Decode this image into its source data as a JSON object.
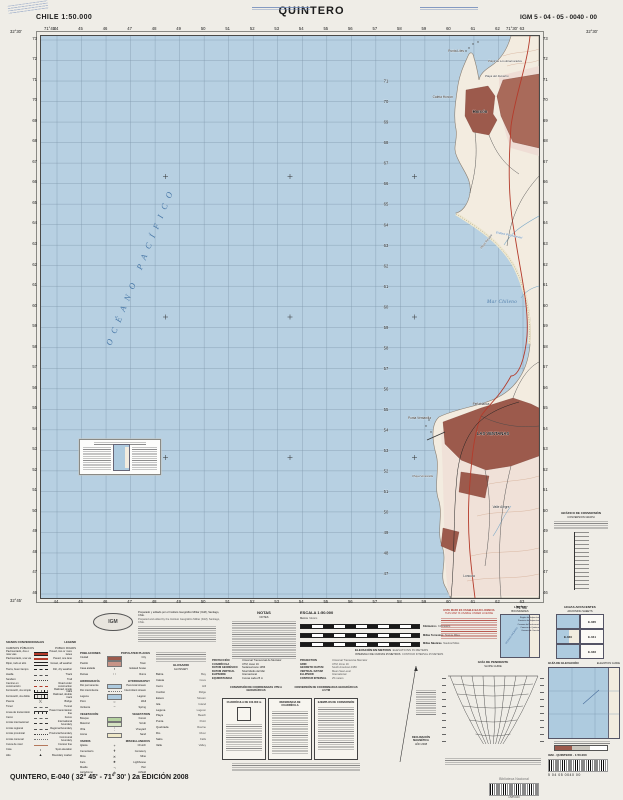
{
  "header": {
    "country_scale": "CHILE  1:50.000",
    "title": "QUINTERO",
    "sheet_code": "IGM 5 - 04 - 05 - 0040 - 00"
  },
  "map": {
    "grid": {
      "eastings": [
        "44",
        "45",
        "46",
        "47",
        "48",
        "49",
        "50",
        "51",
        "52",
        "53",
        "54",
        "55",
        "56",
        "57",
        "58",
        "59",
        "60",
        "61",
        "62",
        "63"
      ],
      "northings": [
        "73",
        "72",
        "71",
        "70",
        "69",
        "68",
        "67",
        "66",
        "65",
        "64",
        "63",
        "62",
        "61",
        "60",
        "59",
        "58",
        "57",
        "56",
        "55",
        "54",
        "53",
        "52",
        "51",
        "50",
        "49",
        "48",
        "47",
        "46"
      ]
    },
    "corner_coords": {
      "nw_lat": "32°30'",
      "nw_lon": "71°45'",
      "ne_lat": "32°30'",
      "ne_lon": "71°30'",
      "sw_lat": "32°45'",
      "se_lon": "71°30'"
    },
    "water_labels": [
      {
        "text": "OCÉANO  PACÍFICO",
        "x": 70,
        "y": 310,
        "rot": -68,
        "size": 8.5,
        "ls": 6.5
      },
      {
        "text": "Mar Chileno",
        "x": 446,
        "y": 267,
        "rot": 0,
        "size": 5,
        "ls": 0.4
      }
    ],
    "place_labels": [
      {
        "text": "Punta Liles",
        "x": 423,
        "y": 16,
        "cls": "pt",
        "anchor": "end"
      },
      {
        "text": "Playa de Los Enamorados",
        "x": 447,
        "y": 26,
        "cls": "beach",
        "anchor": "start"
      },
      {
        "text": "Playa del Durazno",
        "x": 444,
        "y": 41,
        "cls": "beach",
        "anchor": "start"
      },
      {
        "text": "Caleta Horcón",
        "x": 412,
        "y": 62,
        "cls": "pt",
        "anchor": "end"
      },
      {
        "text": "Horcón",
        "x": 439,
        "y": 77,
        "cls": "town",
        "anchor": "middle"
      },
      {
        "text": "Estero Puchuncaví",
        "x": 468,
        "y": 200,
        "cls": "water-sm",
        "anchor": "middle",
        "rot": 12
      },
      {
        "text": "Playa Ritoque",
        "x": 446,
        "y": 206,
        "cls": "beach",
        "anchor": "middle",
        "rot": -52
      },
      {
        "text": "Peñablanca",
        "x": 440,
        "y": 369,
        "cls": "pt",
        "anchor": "middle"
      },
      {
        "text": "LAS VENTANAS",
        "x": 452,
        "y": 399,
        "cls": "town",
        "anchor": "middle"
      },
      {
        "text": "Punta Ventanilla",
        "x": 390,
        "y": 383,
        "cls": "pt",
        "anchor": "end"
      },
      {
        "text": "Playa Ventanilla",
        "x": 392,
        "y": 441,
        "cls": "beach",
        "anchor": "end"
      },
      {
        "text": "Valle Alegre",
        "x": 460,
        "y": 472,
        "cls": "pt",
        "anchor": "middle"
      },
      {
        "text": "Loncura",
        "x": 428,
        "y": 541,
        "cls": "pt",
        "anchor": "middle"
      }
    ]
  },
  "credits": {
    "lines_es": "Preparado y editado por el Instituto Geográfico Militar (IGM), Santiago, Chile.",
    "lines_en": "Prepared and edited by the Instituto Geográfico Militar (IGM), Santiago, Chile."
  },
  "logo": {
    "text": "IGM"
  },
  "notes": {
    "title_es": "NOTAS",
    "title_en": "NOTES"
  },
  "scale": {
    "title": "ESCALA 1:50.000",
    "meters_es": "Metros",
    "meters_en": "Meters",
    "bars": [
      {
        "es": "Kilómetros",
        "en": "Kilometers"
      },
      {
        "es": "Millas Terrestres",
        "en": "Statute Miles"
      },
      {
        "es": "Millas Náuticas",
        "en": "Nautical Miles"
      }
    ]
  },
  "elevation": {
    "line1_es": "ELEVACIÓN EN METROS",
    "line1_en": "ELEVATIONS IN METERS",
    "line2_es": "INTERVALO DE CURVAS 25 METROS",
    "line2_en": "CONTOUR INTERVAL 25 METERS"
  },
  "warning": {
    "line1": "ESTE MAPA ES USABLE BAJO LICENCIA",
    "line2": "THIS MAP IS USABLE UNDER LICENSE"
  },
  "limits": {
    "title_es": "LÍMITES",
    "title_en": "BOUNDARIES",
    "ocean": "OCÉANO PACÍFICO",
    "labels": [
      "Región de Valparaíso",
      "Provincia de Valparaíso",
      "Comuna de Puchuncaví",
      "Comuna de Quintero",
      "Comuna de Concón"
    ]
  },
  "adjoining": {
    "title_es": "HOJAS ADYACENTES",
    "title_en": "ADJOINING SHEETS",
    "cells": [
      [
        "",
        "E-035"
      ],
      [
        "E-040",
        "E-041"
      ],
      [
        "",
        "E-046"
      ]
    ]
  },
  "conversion_graph": {
    "title_es": "GRÁFICO DE CONVERSIÓN",
    "title_en": "CONVERSION GRAPH"
  },
  "legend": {
    "title_es": "SIGNOS CONVENCIONALES",
    "title_en": "LEGEND",
    "sub_es": "CAMINOS PÚBLICOS",
    "sub_en": "PUBLIC ROADS",
    "items": [
      {
        "es": "Pavimentado, dos o más vías",
        "en": "Paved, two or more lanes",
        "sym": "line:road2"
      },
      {
        "es": "Pavimentado, una vía",
        "en": "Paved, one lane",
        "sym": "line:road1"
      },
      {
        "es": "Ripio, todo el año",
        "en": "Gravel, all weather",
        "sym": "line:gravel"
      },
      {
        "es": "Tierra, buen tiempo",
        "en": "Dirt, dry weather",
        "sym": "line:dirt"
      },
      {
        "es": "Huella",
        "en": "Track",
        "sym": "line:track"
      },
      {
        "es": "Sendero",
        "en": "Trail",
        "sym": "line:trail"
      },
      {
        "es": "Camino en construcción",
        "en": "Road under construction",
        "sym": "line:constr"
      },
      {
        "es": "Ferrocarril, vía simple",
        "en": "Railroad, single track",
        "sym": "line:rail1"
      },
      {
        "es": "Ferrocarril, vía doble",
        "en": "Railroad, double track",
        "sym": "line:rail2"
      },
      {
        "es": "Puente",
        "en": "Bridge",
        "sym": "glyph:)("
      },
      {
        "es": "Túnel",
        "en": "Tunnel",
        "sym": "line:fence"
      },
      {
        "es": "Línea de transmisión",
        "en": "Power transmission line",
        "sym": "line:power"
      },
      {
        "es": "Cerco",
        "en": "Fence",
        "sym": "line:fence"
      },
      {
        "es": "Límite internacional",
        "en": "International boundary",
        "sym": "line:bint"
      },
      {
        "es": "Límite regional",
        "en": "Regional boundary",
        "sym": "line:breg"
      },
      {
        "es": "Límite provincial",
        "en": "Provincial boundary",
        "sym": "line:bprov"
      },
      {
        "es": "Límite comunal",
        "en": "Communal boundary",
        "sym": "line:bcom"
      },
      {
        "es": "Curva de nivel",
        "en": "Contour line",
        "sym": "line:contour"
      },
      {
        "es": "Cota",
        "en": "Spot elevation",
        "sym": "glyph:•"
      },
      {
        "es": "Hito",
        "en": "Boundary marker",
        "sym": "glyph:▲"
      }
    ],
    "groups": [
      {
        "es": "POBLACIONES",
        "en": "POPULATED PLACES",
        "items": [
          {
            "es": "Ciudad",
            "en": "City",
            "sym": "box:#9c5a4c"
          },
          {
            "es": "Pueblo",
            "en": "Town",
            "sym": "box:#c79487"
          },
          {
            "es": "Casa aislada",
            "en": "Isolated house",
            "sym": "glyph:▪"
          },
          {
            "es": "Ruinas",
            "en": "Ruins",
            "sym": "glyph:∷"
          }
        ]
      },
      {
        "es": "HIDROGRAFÍA",
        "en": "HYDROGRAPHY",
        "items": [
          {
            "es": "Río permanente",
            "en": "Perennial stream",
            "sym": "box:#aecbdf"
          },
          {
            "es": "Río intermitente",
            "en": "Intermittent stream",
            "sym": "line:bcom"
          },
          {
            "es": "Laguna",
            "en": "Lagoon",
            "sym": "box:#aecbdf"
          },
          {
            "es": "Pozo",
            "en": "Well",
            "sym": "glyph:○"
          },
          {
            "es": "Vertiente",
            "en": "Spring",
            "sym": "glyph:~"
          }
        ]
      },
      {
        "es": "VEGETACIÓN",
        "en": "VEGETATION",
        "items": [
          {
            "es": "Bosque",
            "en": "Forest",
            "sym": "box:#b5d2a0"
          },
          {
            "es": "Matorral",
            "en": "Scrub",
            "sym": "box:#d5e3c2"
          },
          {
            "es": "Viña",
            "en": "Vineyard",
            "sym": "glyph:⋮"
          },
          {
            "es": "Arena",
            "en": "Sand",
            "sym": "box:#efe8c8"
          }
        ]
      },
      {
        "es": "VARIOS",
        "en": "MISCELLANEOUS",
        "items": [
          {
            "es": "Iglesia",
            "en": "Church",
            "sym": "glyph:+"
          },
          {
            "es": "Cementerio",
            "en": "Cemetery",
            "sym": "glyph:✝"
          },
          {
            "es": "Mina",
            "en": "Mine",
            "sym": "glyph:✕"
          },
          {
            "es": "Faro",
            "en": "Lighthouse",
            "sym": "glyph:★"
          },
          {
            "es": "Muelle",
            "en": "Pier",
            "sym": "glyph:¬"
          },
          {
            "es": "Aeródromo",
            "en": "Airfield",
            "sym": "glyph:⊕"
          }
        ]
      }
    ]
  },
  "glossary": {
    "title_es": "GLOSARIO",
    "title_en": "GLOSSARY",
    "pairs": [
      [
        "Bahía",
        "Bay"
      ],
      [
        "Caleta",
        "Cove"
      ],
      [
        "Cerro",
        "Hill"
      ],
      [
        "Cordón",
        "Ridge"
      ],
      [
        "Estero",
        "Stream"
      ],
      [
        "Isla",
        "Island"
      ],
      [
        "Laguna",
        "Lagoon"
      ],
      [
        "Playa",
        "Beach"
      ],
      [
        "Punta",
        "Point"
      ],
      [
        "Quebrada",
        "Ravine"
      ],
      [
        "Río",
        "River"
      ],
      [
        "Salto",
        "Falls"
      ],
      [
        "Valle",
        "Valley"
      ]
    ]
  },
  "projection": {
    "rows": [
      {
        "k_es": "Proyección",
        "v_es": "Universal Transversal de Mercator",
        "k_en": "Projection",
        "v_en": "Universal Transverse Mercator"
      },
      {
        "k_es": "Cuadrícula",
        "v_es": "UTM, Huso 19",
        "k_en": "Grid",
        "v_en": "UTM, Zone 19"
      },
      {
        "k_es": "Datum Geodésico",
        "v_es": "Sudamericano 1956",
        "k_en": "Geodetic Datum",
        "v_en": "South American 1956"
      },
      {
        "k_es": "Datum Vertical",
        "v_es": "Nivel Medio del Mar",
        "k_en": "Vertical Datum",
        "v_en": "Mean Sea Level"
      },
      {
        "k_es": "Elipsoide",
        "v_es": "Internacional",
        "k_en": "Ellipsoid",
        "v_en": "International"
      },
      {
        "k_es": "Equidistancia",
        "v_es": "Curvas cada 25 m",
        "k_en": "Contour Interval",
        "v_en": "25 meters"
      }
    ]
  },
  "conversion": {
    "header1": "CONVERSIÓN DE COORDENADAS UTM A GEOGRÁFICAS",
    "header2": "CONVERSIÓN DE COORDENADAS GEOGRÁFICAS A UTM",
    "boxes": [
      "CUADRÍCULA DE 100.000 m",
      "REFERENCIA DE CUADRÍCULA",
      "EJEMPLOS DE CONVERSIÓN"
    ]
  },
  "declination": {
    "title": "DECLINACIÓN MAGNÉTICA",
    "year": "AÑO 2008"
  },
  "slope_guide": {
    "title_es": "GUÍA DE PENDIENTE",
    "title_en": "SLOPE GUIDE"
  },
  "elevation_guide": {
    "title_es": "GUÍA DE ELEVACIÓN",
    "title_en": "ELEVATION GUIDE"
  },
  "barcode1": {
    "label": "IGM   - QUINTERO -   1:50.000",
    "digits": "5    04    05    0040    00"
  },
  "stamp": {
    "name": "Biblioteca Nacional",
    "number": "1585040"
  },
  "footer": {
    "text": "QUINTERO, E-040 ( 32° 45' - 71° 30' ) 2a EDICIÓN 2008"
  }
}
